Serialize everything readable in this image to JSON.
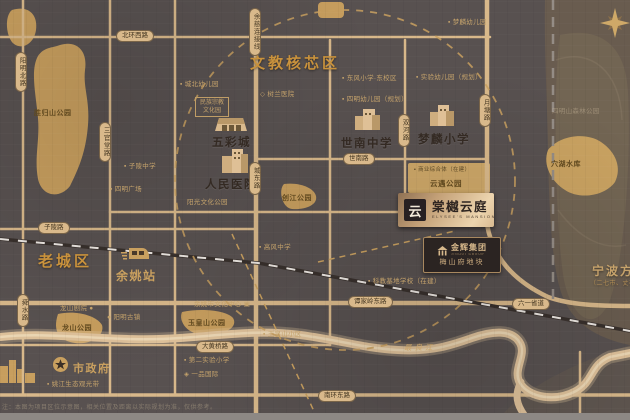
{
  "title_labels": {
    "core_area": "文教核芯区",
    "old_town": "老城区",
    "ningbo_direction": "宁波方向",
    "ningbo_sub": "（二七市、丈亭）"
  },
  "plaque": {
    "logo_glyph": "云",
    "name": "棠樾云庭",
    "name_en": "ELYSEE'S MANSION"
  },
  "developer": {
    "group": "金辉集团",
    "group_en": "JINHUI GROUP",
    "plot": "梅山府地块"
  },
  "stations": {
    "yuyao_station": "余姚站",
    "city_hall": "市政府"
  },
  "pois": {
    "wucai_mall": "五彩城",
    "peoples_hospital": "人民医院",
    "shinan_middle_school": "世南中学",
    "menglin_primary": "梦麟小学"
  },
  "parks": {
    "shenggui": "胜归山公园",
    "longshan": "龙山公园",
    "yuhuang": "玉皇山公园",
    "chuangjiang": "创江公园",
    "yunyu": "云遇公园",
    "yunyu_note": "▪ 商业综合体（在建）",
    "xuehu_lake": "穴湖水库",
    "forest": "四明山森林公园",
    "river": "最良江"
  },
  "roads": {
    "beihuan_west": "北环西路",
    "yuci_link": "余慈连接线",
    "ziling": "子陵路",
    "shinan": "世南路",
    "chengdong": "城东路",
    "yangming_north": "阳明北路",
    "sanguantang": "三官堂路",
    "shunshui": "舜水路",
    "shuanghe": "双河路",
    "yuetang": "月塘路",
    "tanjialing_east": "谭家岭东路",
    "liuyi_provincial": "六一省道",
    "nanhuan_east": "南环东路",
    "dahuangqiao": "大黄桥路"
  },
  "small_labels": [
    "▪ 城北幼儿园",
    "民族宗教",
    "文化园",
    "◇ 树兰医院",
    "▪ 东风小学·东校区",
    "▪ 四明幼儿园（规划）",
    "▪ 梦麟幼儿园",
    "▪ 实验幼儿园（规划）",
    "▪ 子陵中学",
    "▪ 四明广场",
    "阳光文化公园",
    "余姚市文化中心 ▣",
    "● 阳明古镇",
    "龙山剧院 ●",
    "▪ 姚江生态观光带",
    "▪ 第二实验小学",
    "◈ 一品国际",
    "▪ 科教基地学校（在建）",
    "▪ 高风中学",
    "▪ 玉皇山小区"
  ],
  "disclaimer": "注：本图为项目区位示意图，相关位置及距离以实际规划为准，仅供参考。",
  "colors": {
    "background": "#585150",
    "road": "#d8b88a",
    "park_gold": "#c79e5e",
    "accent_gold": "#c9a05f",
    "title_gold": "#c9923c",
    "dark_text": "#342a23"
  }
}
